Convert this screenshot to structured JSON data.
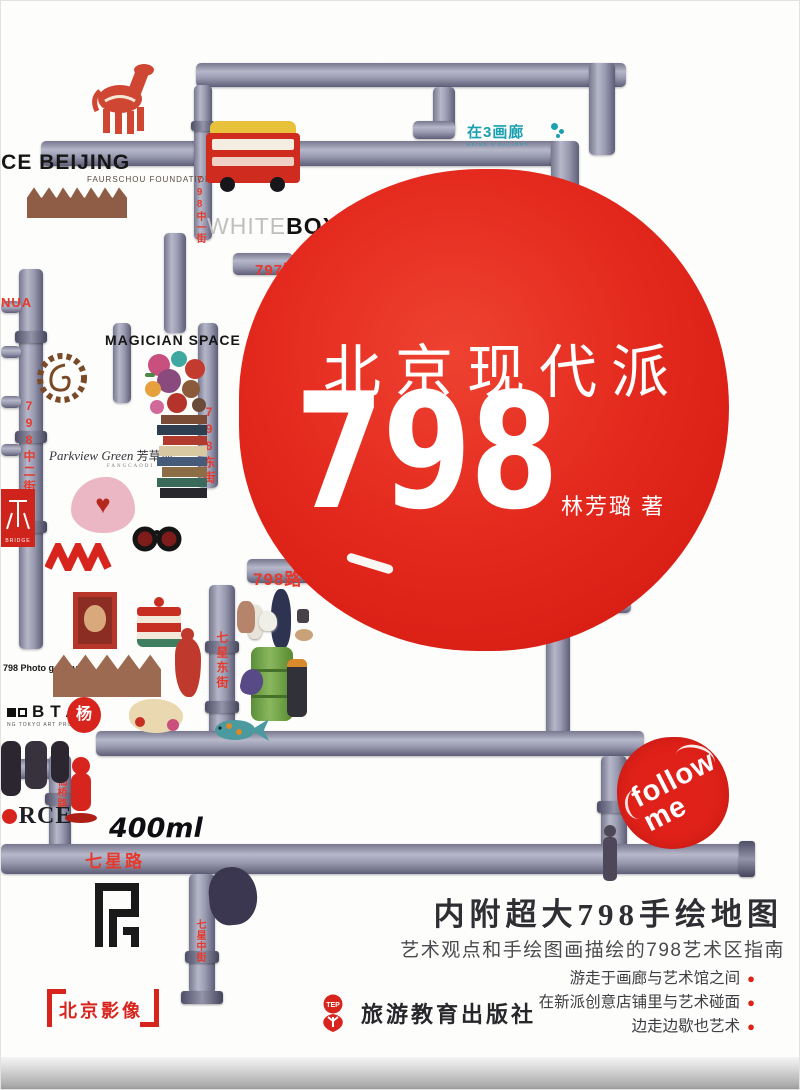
{
  "colors": {
    "accent_red": "#df2119",
    "street_red": "#e6392c",
    "teal": "#1ba0b0",
    "pipe_gray": "#9a9bb1"
  },
  "title": {
    "line1": "北京现代派",
    "number": "798",
    "author": "林芳璐 著"
  },
  "badges": {
    "follow_line1": "follow",
    "follow_line2": "me",
    "series": "北京影像"
  },
  "footer": {
    "tagline": "内附超大798手绘地图",
    "subtitle": "艺术观点和手绘图画描绘的798艺术区指南",
    "bullets": [
      {
        "text": "游走于画廊与艺术馆之间"
      },
      {
        "text": "在新派创意店铺里与艺术碰面"
      },
      {
        "text": "边走边歇也艺术"
      }
    ],
    "bullet_dot": "●",
    "publisher": "旅游教育出版社",
    "publisher_logo": "TEP"
  },
  "map": {
    "streets": [
      {
        "label": "797路"
      },
      {
        "label": "798中一街"
      },
      {
        "label": "798中二街"
      },
      {
        "label": "798东街"
      },
      {
        "label": "798路"
      },
      {
        "label": "七星东街"
      },
      {
        "label": "酒仙桥路"
      },
      {
        "label": "七星路"
      },
      {
        "label": "七星中街"
      }
    ],
    "labels": {
      "ace": "ACE BEIJING",
      "faurschou": "FAURSCHOU FOUNDATION",
      "whitebox_light": "WHITE",
      "whitebox_bold": "BOX",
      "being3_zh": "在3画廊",
      "being3_en": "BEING 3 GALLERY",
      "magician": "MAGICIAN SPACE",
      "parkview_script": "Parkview Green",
      "parkview_zh": "芳草地",
      "parkview_en": "FANGCAODI",
      "photo_gallery": "798 Photo gallery",
      "btap": "BTAP",
      "btap_sub": "NG TOKYO ART PROJECTS",
      "force_f": "F",
      "force_rest": "RCE",
      "brand_400ml": "400ml",
      "yang_seal": "杨",
      "bridge_seal_sub": "BRIDGE",
      "hua_fragment": "NUA"
    }
  }
}
